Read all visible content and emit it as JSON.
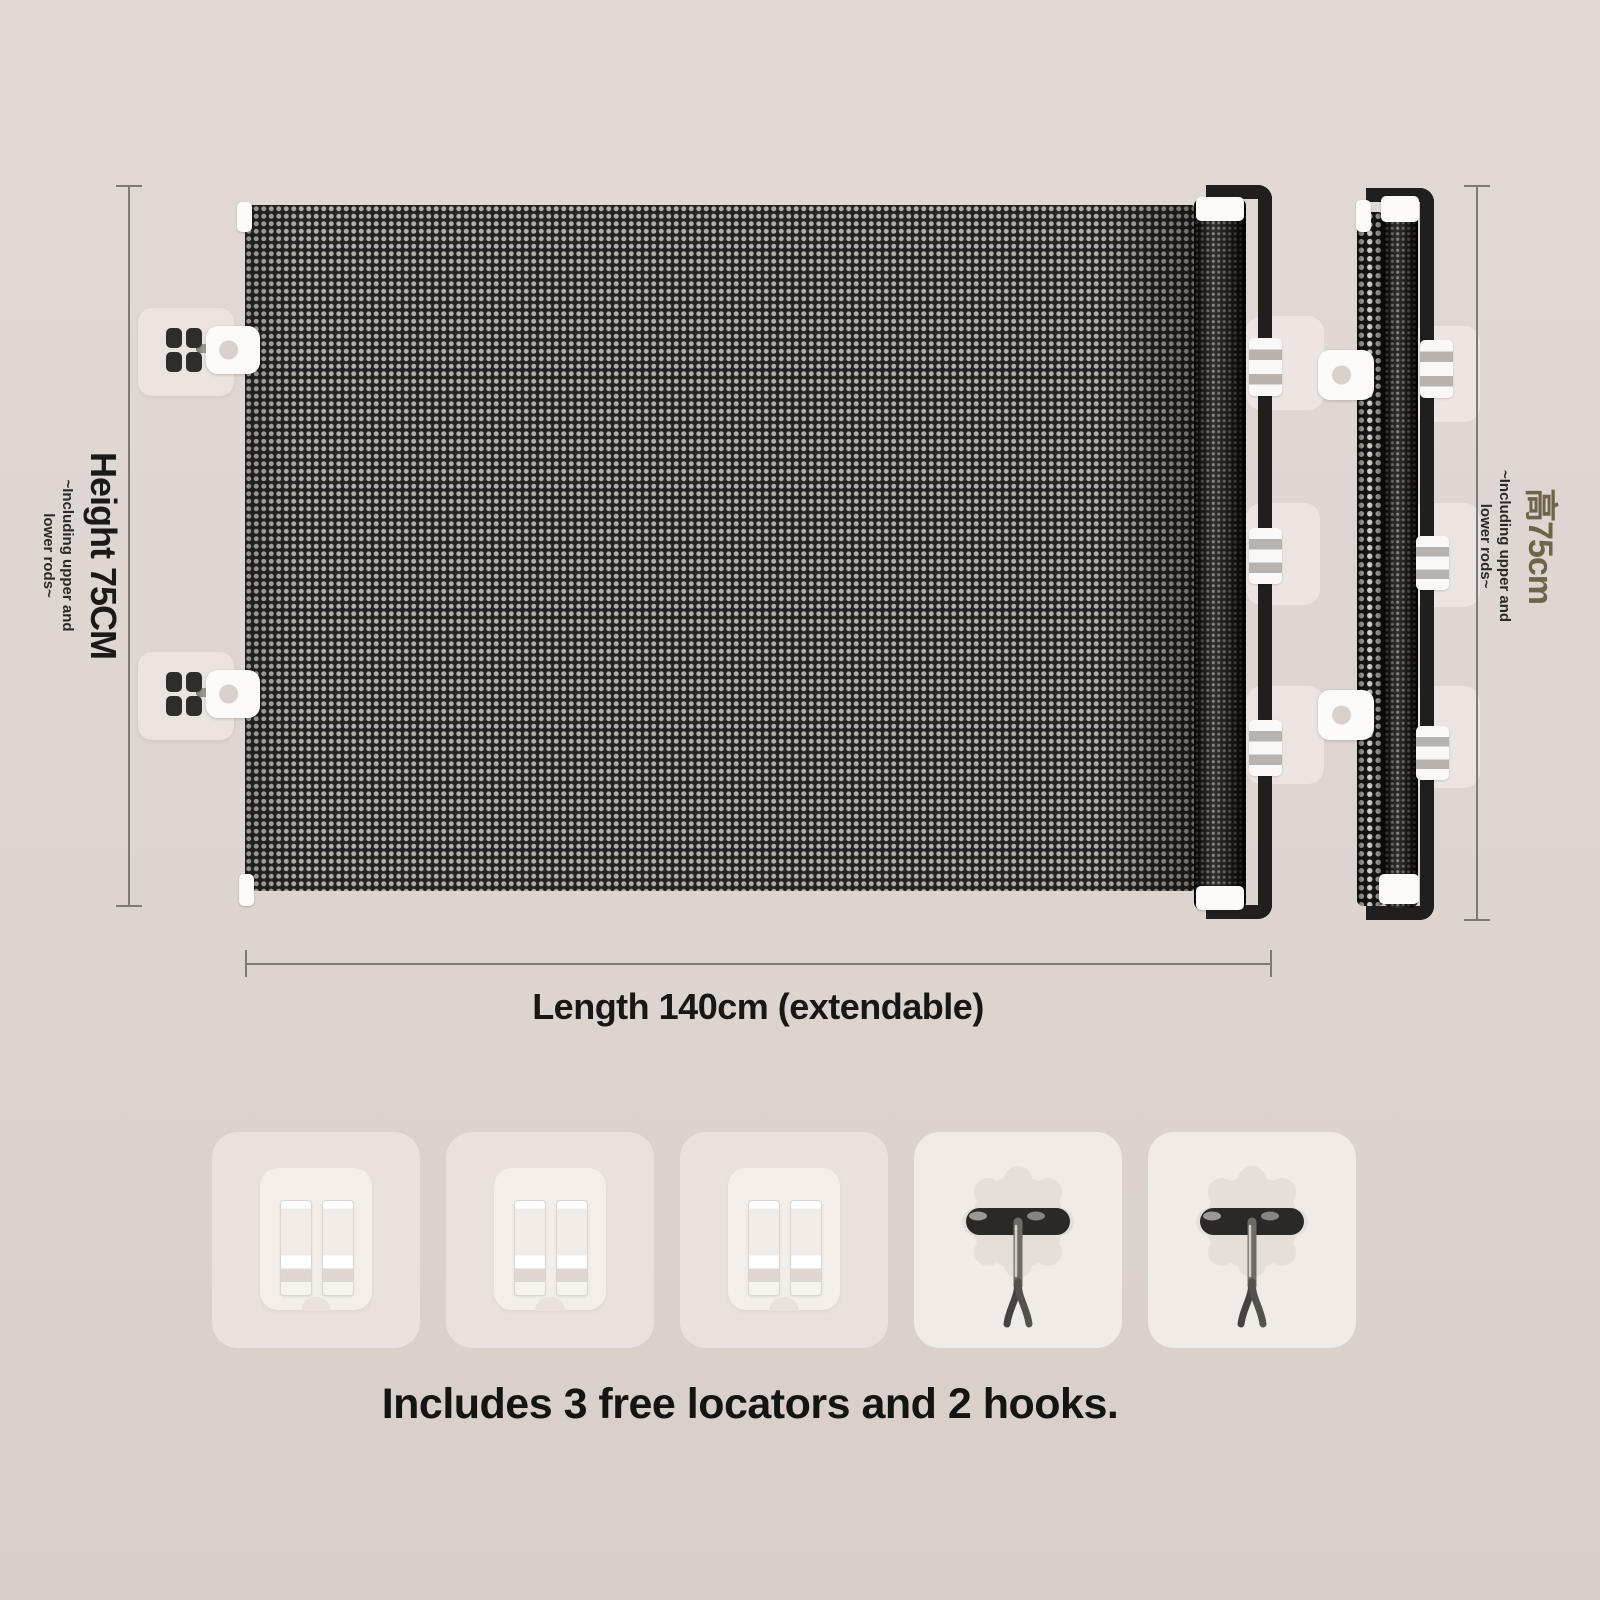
{
  "background": {
    "top": "#e1d9d4",
    "bottom": "#d8cfc9"
  },
  "colors": {
    "mesh_dark": "#262422",
    "mesh_dot": "#b4aea8",
    "frame": "#201f1d",
    "dimension_line": "#7d7a77",
    "text": "#1b1a19",
    "right_height_label": "#6e6449",
    "pad": "#eae3de",
    "tile_locator": "#e9e1dd",
    "tile_hook": "#f1ebe8"
  },
  "annotations": {
    "height_left": {
      "label": "Height 75CM",
      "note_line1": "~Including upper and",
      "note_line2": "lower rods~"
    },
    "height_right": {
      "label": "高75cm",
      "note_line1": "~Including upper and",
      "note_line2": "lower rods~"
    },
    "length": {
      "label": "Length 140cm (extendable)"
    },
    "caption": "Includes 3 free locators and 2 hooks."
  },
  "accessories": {
    "tiles": [
      {
        "type": "locator"
      },
      {
        "type": "locator"
      },
      {
        "type": "locator"
      },
      {
        "type": "hook"
      },
      {
        "type": "hook"
      }
    ],
    "locator_count": 3,
    "hook_count": 2
  }
}
